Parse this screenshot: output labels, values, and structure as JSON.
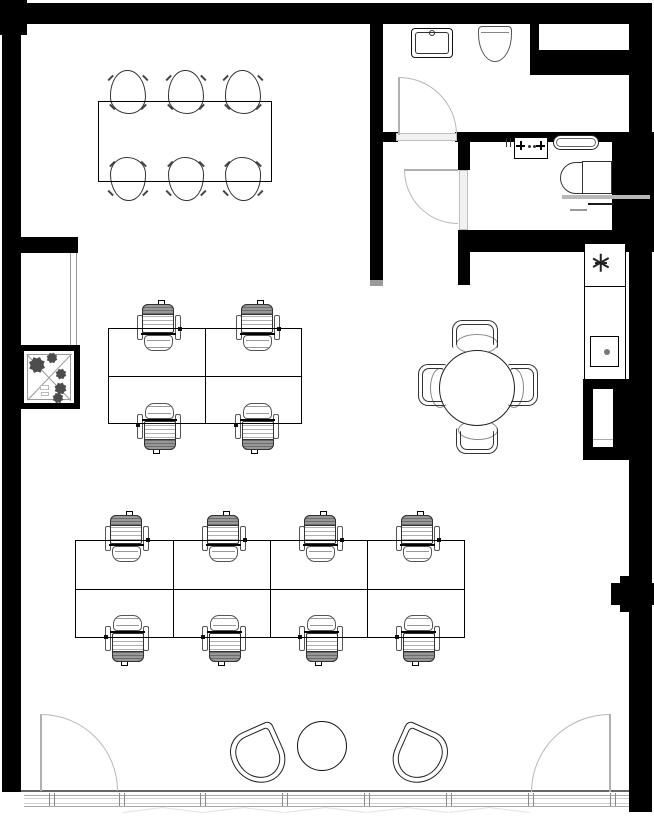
{
  "floor_plan": {
    "type": "office floor plan, black-and-white CAD drawing",
    "rooms": [
      {
        "name": "open-office",
        "items": [
          "conference table with 6 chairs",
          "quad desk cluster with 4 task chairs",
          "eight-desk cluster with 8 task chairs",
          "round meeting table with 4 chairs",
          "lounge with 2 tub chairs and round coffee table"
        ]
      },
      {
        "name": "restroom-north",
        "items": [
          "vanity sink",
          "toilet"
        ],
        "door": "swing door"
      },
      {
        "name": "vestibule",
        "items": [],
        "door": "swing door"
      },
      {
        "name": "restroom-east",
        "items": [
          "faucet sink",
          "towel tray",
          "toilet",
          "grab bars"
        ]
      },
      {
        "name": "kitchenette",
        "items": [
          "counter",
          "burner star symbol",
          "counter sink with drain"
        ]
      },
      {
        "name": "elevator-shaft",
        "items": [
          "crossed diagonals symbol",
          "plant symbols"
        ]
      },
      {
        "name": "entry",
        "items": [
          "glazed storefront wall",
          "left entry swing door",
          "right entry swing door"
        ]
      }
    ],
    "counts": {
      "task_chairs": 12,
      "conference_chairs": 6,
      "meeting_chairs": 4,
      "tub_chairs": 2,
      "desks": 12,
      "tables": 4,
      "doors": 4,
      "toilets": 2,
      "sinks": 3
    },
    "colors": {
      "wall": "#000000",
      "line": "#222222",
      "door_swing": "#b8b8b8",
      "shade_gray": "#9a9a9a",
      "background": "#ffffff"
    }
  }
}
